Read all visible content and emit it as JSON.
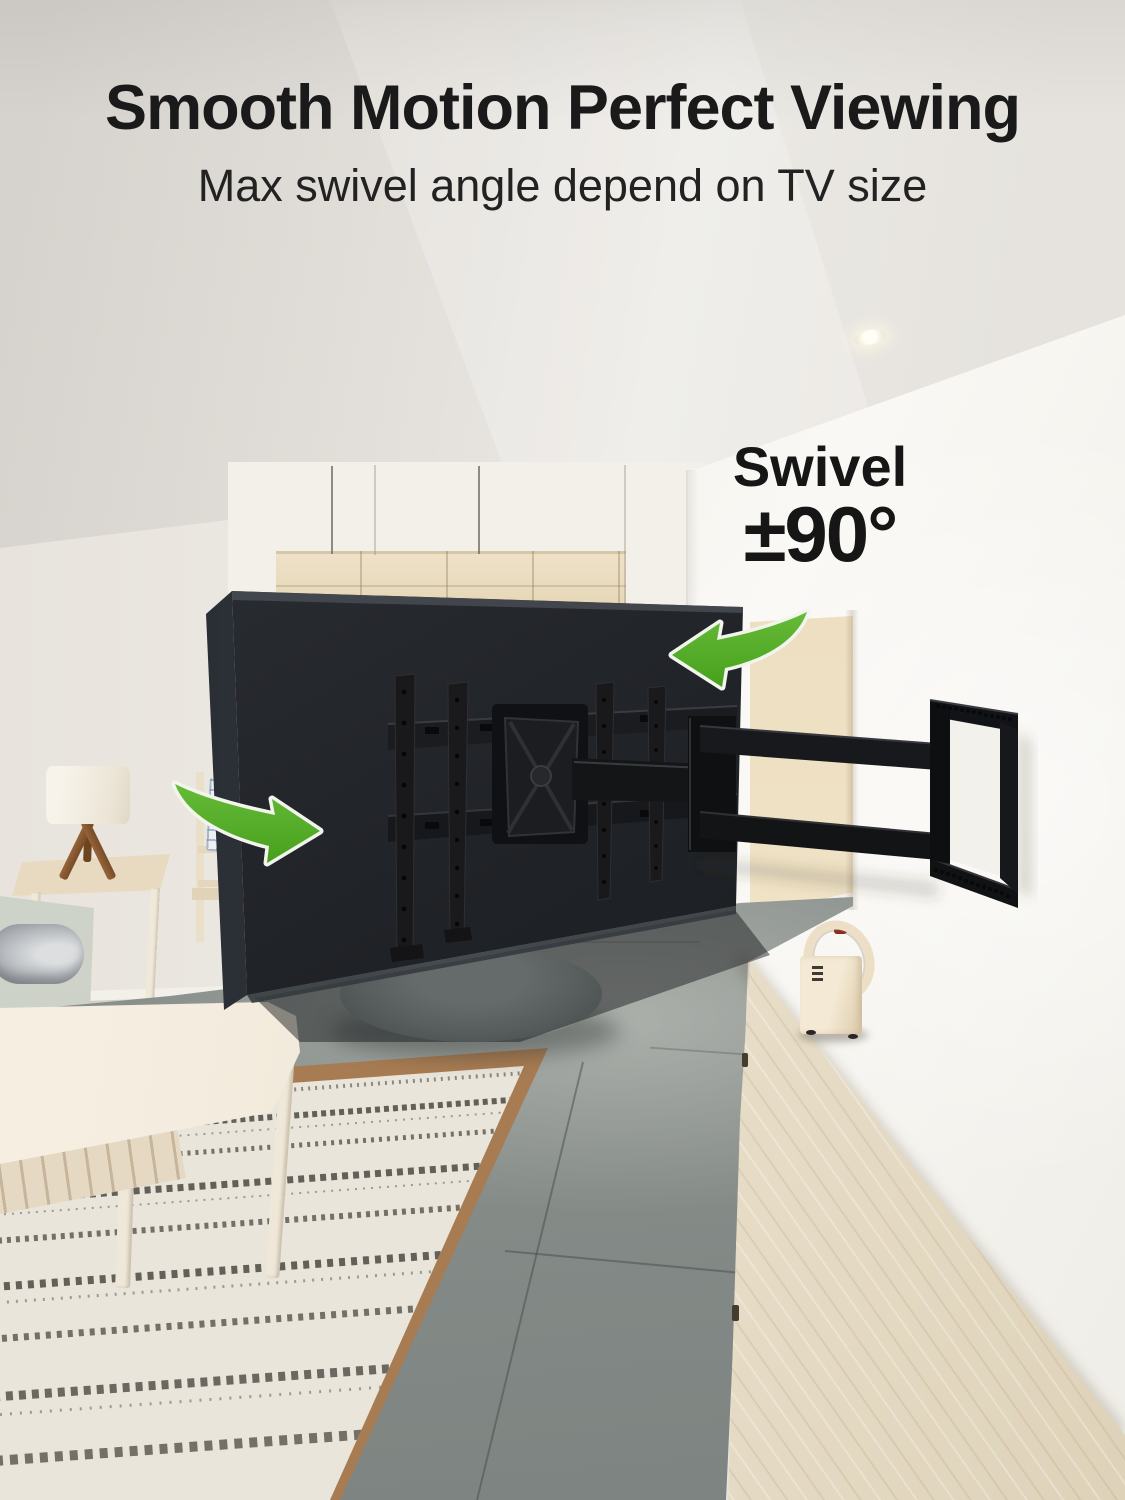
{
  "header": {
    "title": "Smooth Motion Perfect Viewing",
    "subtitle": "Max swivel angle depend on TV size"
  },
  "annotation": {
    "label": "Swivel",
    "value": "±90°"
  },
  "colors": {
    "accent_green": "#53aa26",
    "arrow_outline": "#f1f5ec",
    "title_text": "#1a1a1a",
    "tv_panel": "#202328",
    "mount_black": "#141518",
    "wall_white": "#f6f4ef",
    "niche_beige": "#ead9ba",
    "ceiling": "#e3dfda",
    "floor_gray": "#8b908c",
    "rug_field": "#e9e5da",
    "rug_border": "#a87c52",
    "wood_light": "#efe8da"
  },
  "icons": [
    {
      "name": "swivel-arrow-left-icon",
      "meaning": "swivel direction toward viewer left"
    },
    {
      "name": "swivel-arrow-right-icon",
      "meaning": "swivel direction toward viewer right"
    }
  ]
}
